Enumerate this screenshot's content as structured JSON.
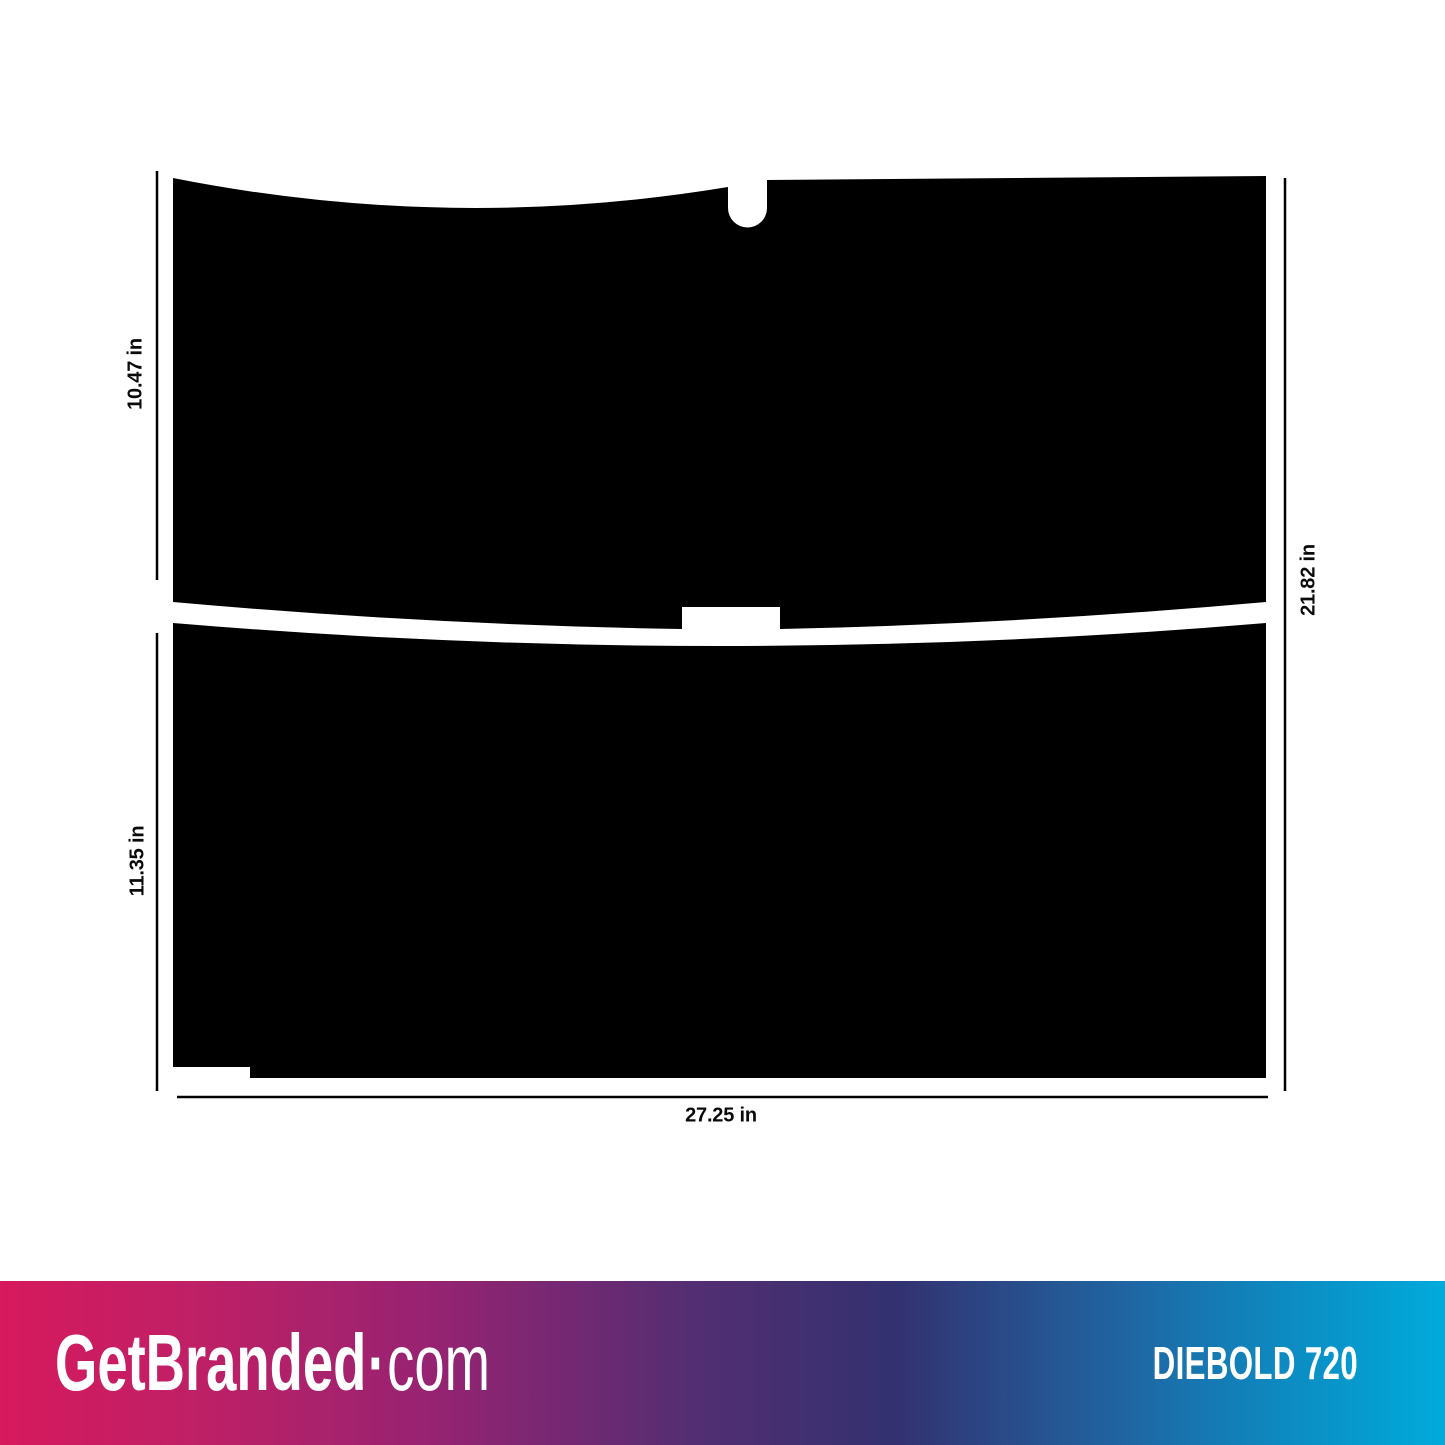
{
  "diagram": {
    "panel_color": "#000000",
    "line_color": "#000000",
    "dimensions": {
      "top_left": "10.47 in",
      "bottom_left": "11.35 in",
      "right": "21.82 in",
      "bottom": "27.25 in"
    }
  },
  "footer": {
    "brand": {
      "name": "GetBranded",
      "separator": "·",
      "tld": "com"
    },
    "product_name": "DIEBOLD 720",
    "gradient_stops": [
      "#d7195d 0%",
      "#be2066 14%",
      "#962372 30%",
      "#532e72 48%",
      "#333170 62%",
      "#1f66a3 78%",
      "#0b8ec4 90%",
      "#00abdb 100%"
    ]
  }
}
